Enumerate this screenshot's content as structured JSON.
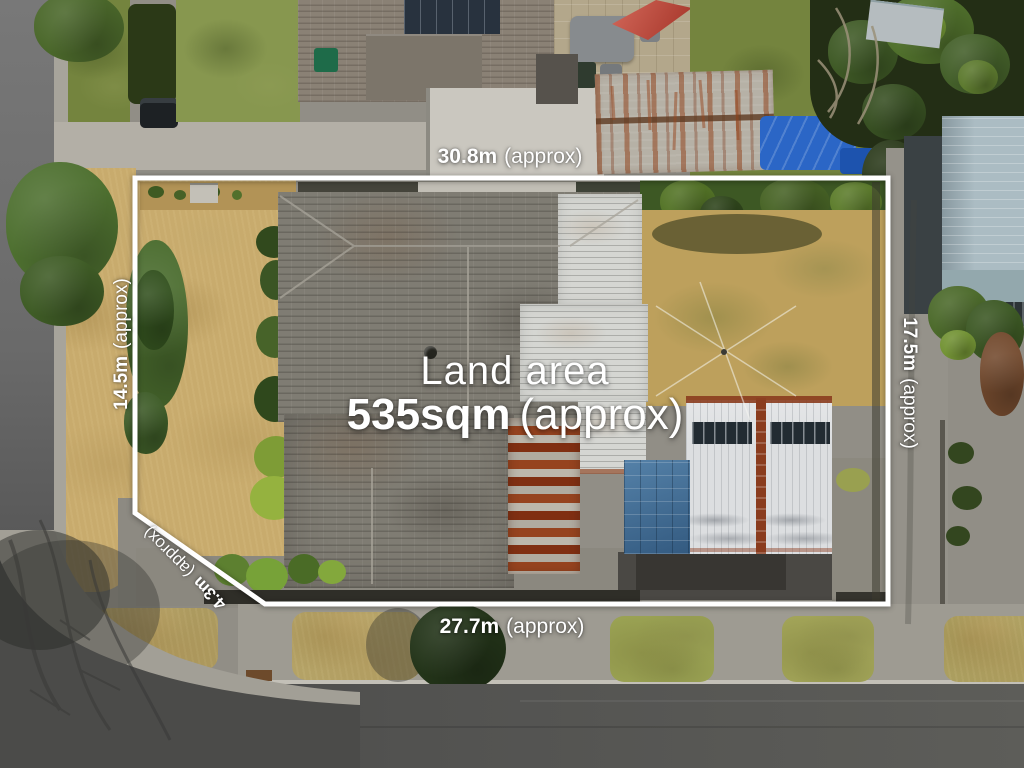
{
  "annotations": {
    "center": {
      "label": "Land area",
      "value": "535sqm",
      "approx": "(approx)"
    },
    "top": {
      "value": "30.8m",
      "approx": "(approx)"
    },
    "bottom": {
      "value": "27.7m",
      "approx": "(approx)"
    },
    "left": {
      "value": "14.5m",
      "approx": "(approx)"
    },
    "right": {
      "value": "17.5m",
      "approx": "(approx)"
    },
    "corner": {
      "value": "4.3m",
      "approx": "(approx)"
    }
  },
  "boundary": {
    "color": "#ffffff",
    "points": "135,178 888,178 888,604 265,604 135,513"
  },
  "scene": {
    "description": "Aerial photograph of a residential property with surveyed boundary overlay",
    "colors": {
      "roof_shingle": "#7f7c73",
      "roof_white_metal": "#d5d6d2",
      "rust": "#96431f",
      "dry_grass": "#c8ab6d",
      "green_lawn": "#74843e",
      "asphalt_road": "#4b4b49",
      "concrete": "#9e9b92",
      "tarp_blue": "#2b66c6",
      "neighbor_roof": "#abbcc3",
      "tree_green": "#4a6c2e"
    }
  }
}
